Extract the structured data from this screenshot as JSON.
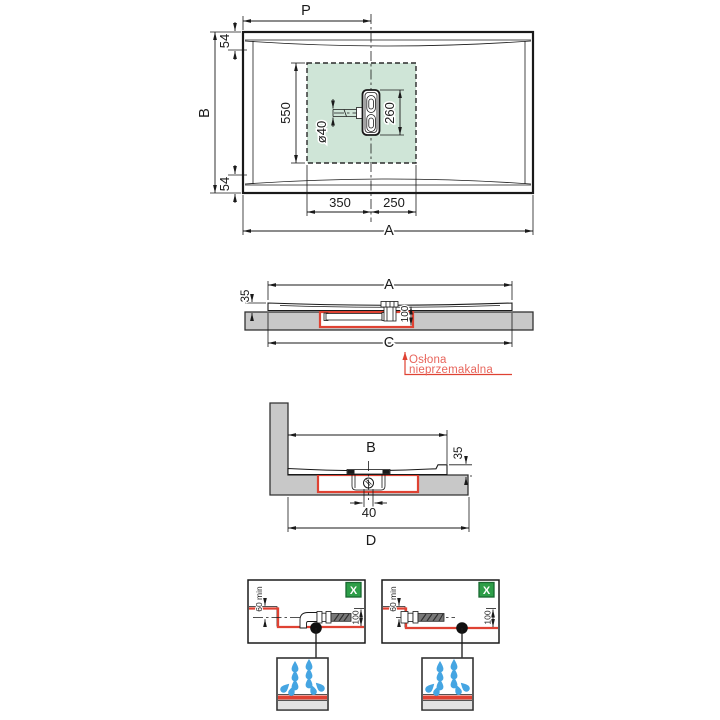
{
  "colors": {
    "red_line": "#df4233",
    "red_text": "#e8655c",
    "green_zone": "#cfe5d7",
    "green_badge": "#2d9e48",
    "slab_gray": "#c8c8c8",
    "water_blue": "#45a5e2"
  },
  "top_view": {
    "dim_p": "P",
    "dim_b": "B",
    "dim_rim_top": "54",
    "dim_rim_bottom": "54",
    "dim_zone_height": "550",
    "dim_drain_length": "260",
    "dim_pipe_diameter": "ø40",
    "dim_left_offset": "350",
    "dim_right_offset": "250",
    "dim_a": "A"
  },
  "front_section": {
    "dim_a": "A",
    "dim_tray_height": "35",
    "dim_recess_depth": "100",
    "dim_c": "C",
    "callout": {
      "line1": "Osłona",
      "line2": "nieprzemakalna"
    }
  },
  "side_section": {
    "dim_b": "B",
    "dim_tray_height": "35",
    "dim_pipe": "40",
    "dim_d": "D"
  },
  "details": {
    "left": {
      "dim_min_depth": "60 min",
      "dim_recess_depth": "100",
      "badge": "X"
    },
    "right": {
      "dim_min_depth": "60 min",
      "dim_recess_depth": "100",
      "badge": "X"
    }
  }
}
